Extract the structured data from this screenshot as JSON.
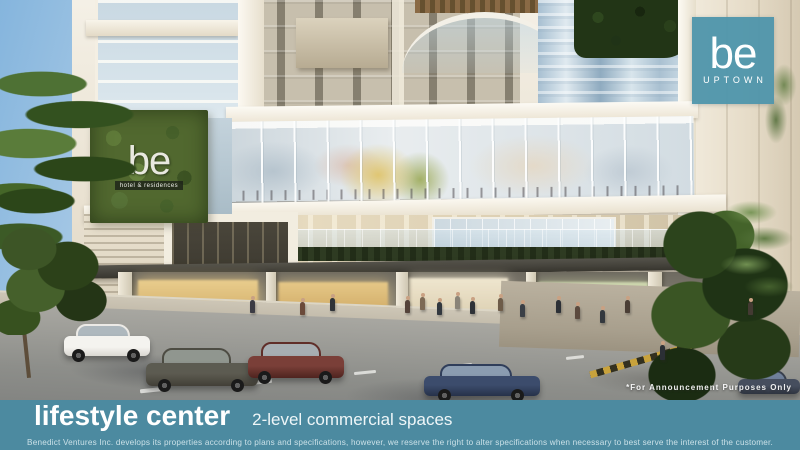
{
  "brand": {
    "logo_word": "be",
    "logo_sub": "UPTOWN",
    "building_sign_word": "be",
    "building_sign_sub": "hotel & residences"
  },
  "caption": {
    "title": "lifestyle center",
    "subtitle": "2-level commercial spaces"
  },
  "annotation": "*For Announcement Purposes Only",
  "disclaimer": "Benedict Ventures Inc. develops its properties according to plans and specifications, however, we reserve the right to alter specifications when necessary to best serve the interest of the customer.",
  "colors": {
    "caption_band": "#4C8AA0",
    "logo_plate": "#4E95AB",
    "green_wall": "#51682F",
    "sky": "#8FBCE0"
  }
}
